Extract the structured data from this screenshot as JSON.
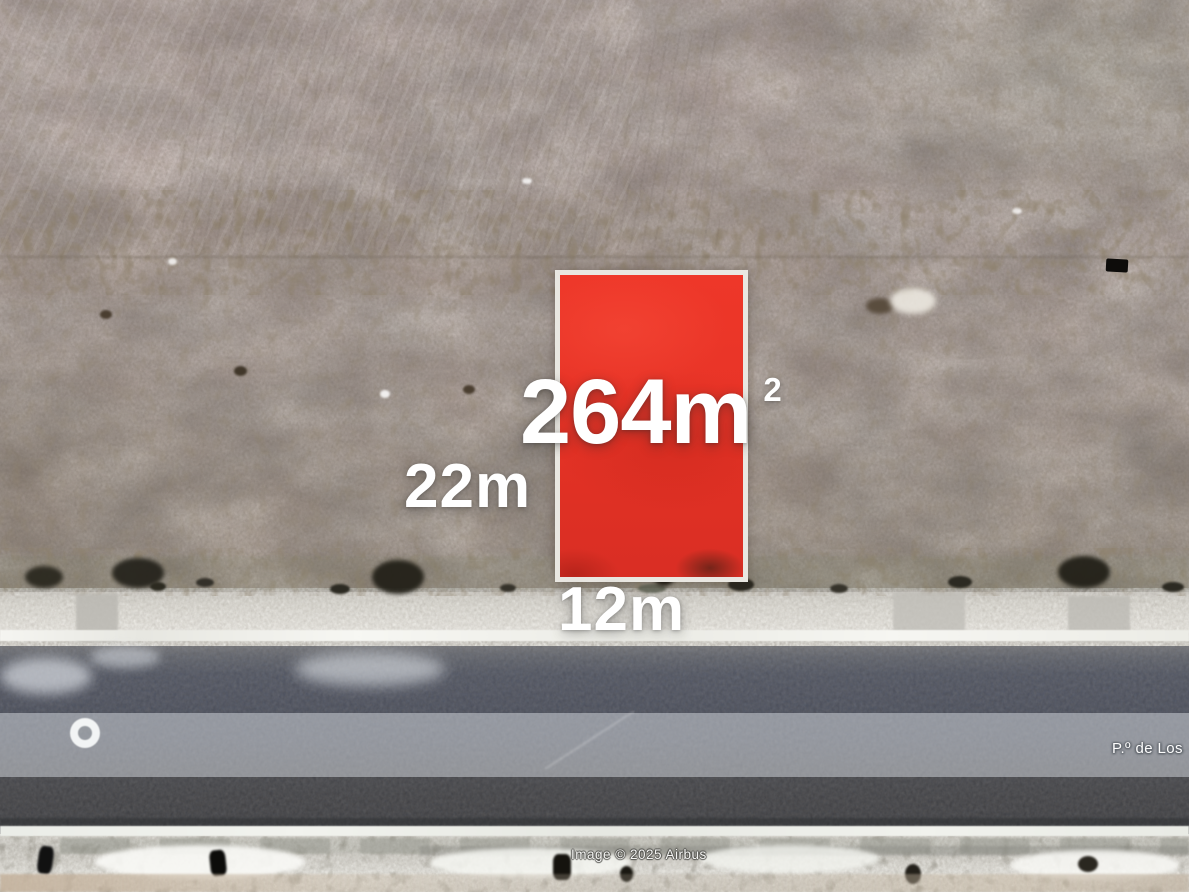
{
  "map": {
    "view": "satellite-aerial",
    "plot": {
      "area_value": "264m",
      "area_superscript": "2",
      "depth_label": "22m",
      "width_label": "12m",
      "fill_color": "#e83427",
      "border_color": "#e9e7e1"
    },
    "road": {
      "name": "P.º de Los"
    },
    "attribution": {
      "text": "Image © 2025 Airbus"
    },
    "colors": {
      "terrain": "#b7a9a4",
      "sidewalk": "#e3e1db",
      "road_asphalt": "#4c515e",
      "road_light_band": "#9aa0ab",
      "label_text": "#ffffff"
    }
  }
}
